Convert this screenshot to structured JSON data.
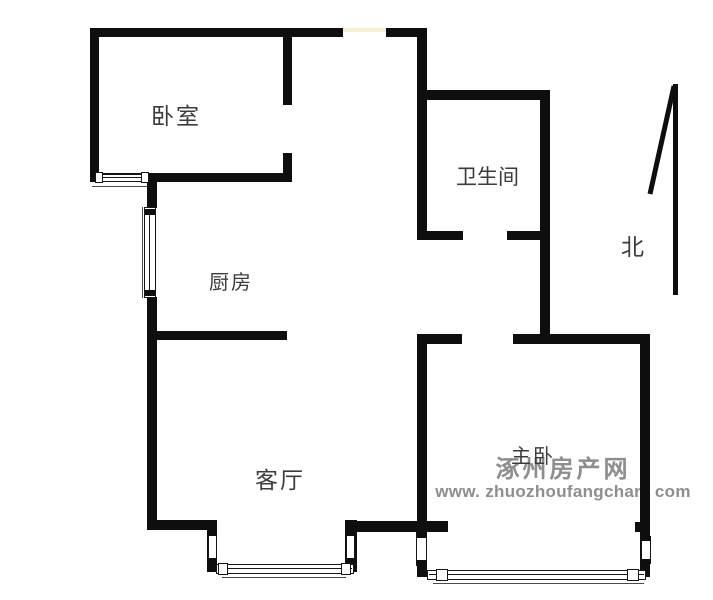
{
  "floorplan": {
    "rooms": {
      "bedroom": {
        "label": "卧室"
      },
      "kitchen": {
        "label": "厨房"
      },
      "bathroom": {
        "label": "卫生间"
      },
      "living_room": {
        "label": "客厅"
      },
      "master_bedroom": {
        "label": "主卧"
      }
    },
    "compass": {
      "north_label": "北"
    },
    "watermark": {
      "site_name": "涿州房产网",
      "site_url": "www. zhuozhoufangchan. com"
    },
    "colors": {
      "wall": "#0e0e0e",
      "room_label_text": "#3c3c3c",
      "watermark_text": "#8e8e8e",
      "top_window_highlight": "#f4eed2"
    }
  }
}
